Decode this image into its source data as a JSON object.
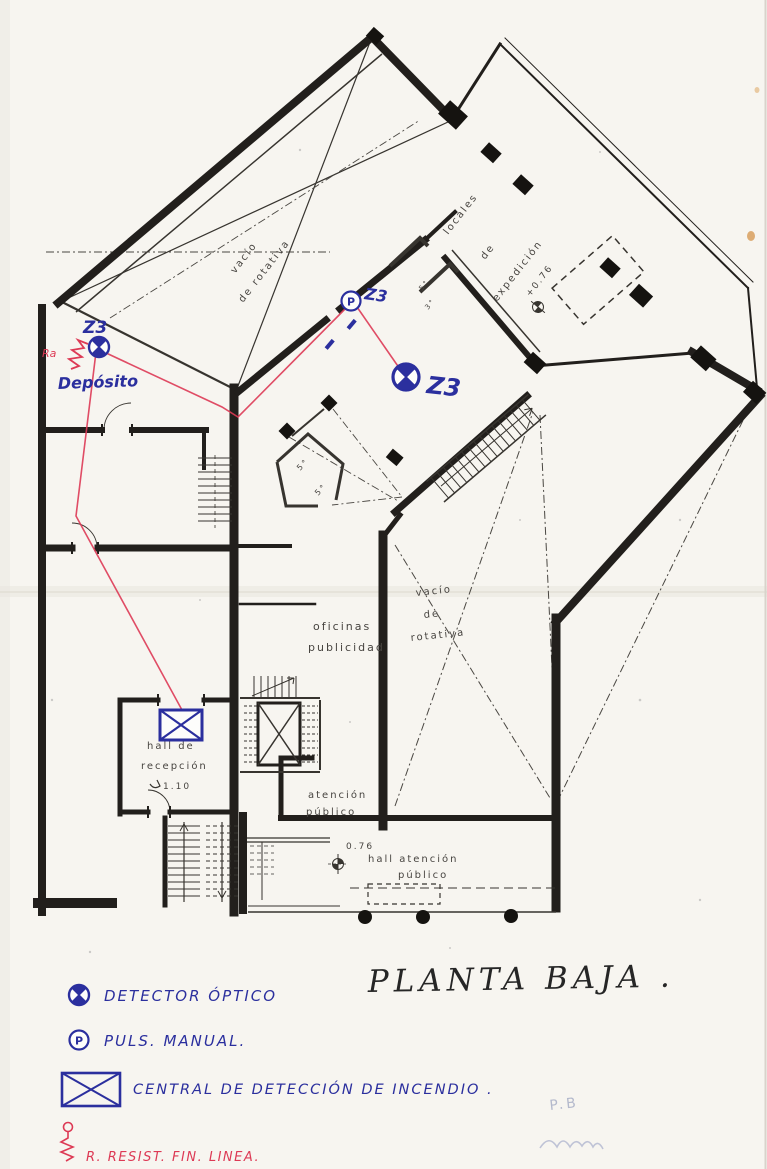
{
  "document": {
    "title": "PLANTA BAJA .",
    "type": "scanned fire-detection floor plan"
  },
  "plan": {
    "labels": {
      "vacio_top_1": "vacío",
      "vacio_top_2": "de rotativa",
      "locales_1": "locales",
      "locales_2": "de",
      "locales_3": "expedición",
      "level_expedicion": "+0.76",
      "oficinas_1": "oficinas",
      "oficinas_2": "publicidad",
      "vacio_right_1": "vacío",
      "vacio_right_2": "de",
      "vacio_right_3": "rotativa",
      "hall_recepcion_1": "hall de",
      "hall_recepcion_2": "recepción",
      "hall_recepcion_level": "1.10",
      "atencion_1": "atención",
      "atencion_2": "público",
      "hall_atencion_level": "0.76",
      "hall_atencion_1": "hall atención",
      "hall_atencion_2": "público",
      "room_a": "5°",
      "room_b": "5°",
      "room_c": "5°",
      "room_d": "3°"
    },
    "annotations": {
      "zone_1": "Z3",
      "zone_2": "Z3",
      "zone_3": "Z3",
      "deposito": "Depósito",
      "resistor_tag": "Ra"
    }
  },
  "legend": {
    "detector": "DETECTOR ÓPTICO",
    "pulsador": "PULS. MANUAL.",
    "central": "CENTRAL DE DETECCIÓN DE INCENDIO .",
    "resistor": "R.   RESIST. FIN. LINEA."
  },
  "pencil": {
    "note": "P.B"
  },
  "colors": {
    "ink_blue": "#2b2f9e",
    "ink_red": "#dd3a55",
    "wall_black": "#221f1c",
    "paper": "#f7f5f0",
    "pencil_gray": "#b4b9cc"
  }
}
